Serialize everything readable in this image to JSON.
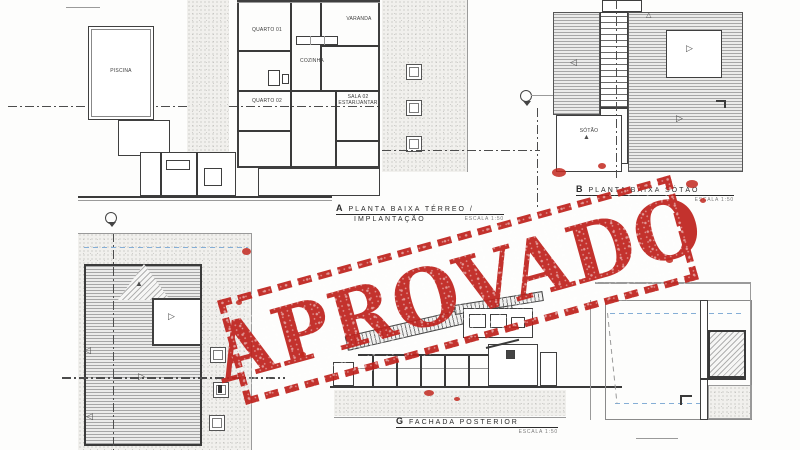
{
  "stamp": {
    "text": "APROVADO",
    "color": "#bf231e"
  },
  "captions": {
    "terreo": {
      "marker": "A",
      "title": "PLANTA BAIXA TÉRREO /",
      "subtitle": "IMPLANTAÇÃO",
      "scale": "ESCALA  1:50"
    },
    "sotao": {
      "marker": "B",
      "title": "PLANTA BAIXA SÓTÃO",
      "scale": "ESCALA  1:50"
    },
    "fachada": {
      "marker": "G",
      "title": "FACHADA POSTERIOR",
      "scale": "ESCALA  1:50"
    }
  },
  "rooms": {
    "quarto01": "QUARTO 01",
    "varanda": "VARANDA",
    "cozinha": "COZINHA",
    "quarto02": "QUARTO 02",
    "sala02": "SALA 02 ESTAR/JANTAR",
    "piscina": "PISCINA",
    "sotao": "SÓTÃO"
  },
  "colors": {
    "ink": "#333333",
    "stamp_red": "#bf231e",
    "blue_guide": "#85aed6"
  }
}
